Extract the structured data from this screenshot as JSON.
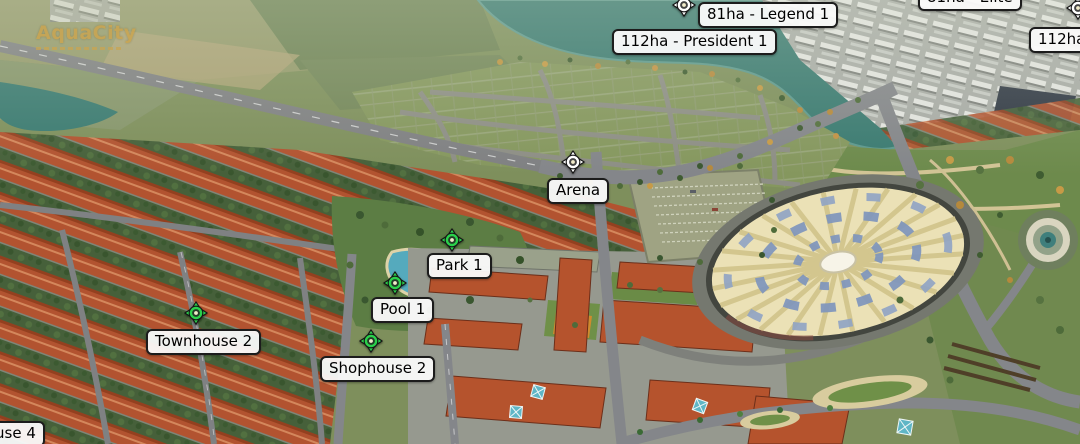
{
  "view": {
    "type": "3d-aerial-masterplan",
    "width_px": 1080,
    "height_px": 444
  },
  "logo": {
    "text": "AquaCity",
    "color": "#c9a552"
  },
  "labels": [
    {
      "id": "legend-1",
      "text": "81ha - Legend 1",
      "marker": "white"
    },
    {
      "id": "president-1",
      "text": "112ha - President 1",
      "marker": "none"
    },
    {
      "id": "elite",
      "text": "81ha - Elite",
      "marker": "none"
    },
    {
      "id": "zone-112ha",
      "text": "112ha",
      "marker": "white"
    },
    {
      "id": "arena",
      "text": "Arena",
      "marker": "white"
    },
    {
      "id": "park-1",
      "text": "Park 1",
      "marker": "green"
    },
    {
      "id": "pool-1",
      "text": "Pool 1",
      "marker": "green"
    },
    {
      "id": "townhouse-2",
      "text": "Townhouse 2",
      "marker": "green"
    },
    {
      "id": "shophouse-2",
      "text": "Shophouse 2",
      "marker": "green"
    },
    {
      "id": "clipped-corner",
      "text": "use 4",
      "marker": "none"
    }
  ],
  "colors": {
    "marker_green": "#2bd14b",
    "marker_white": "#ffffff",
    "label_bg": "#fafafa",
    "label_border": "#1c1c1c",
    "water": "#3a7a71",
    "roof_red": "#b25330",
    "field_olive": "#7e8f5c",
    "arena_roof_cream": "#ebe1b6",
    "arena_blue": "#7e95bd",
    "logo_gold": "#c9a552"
  }
}
